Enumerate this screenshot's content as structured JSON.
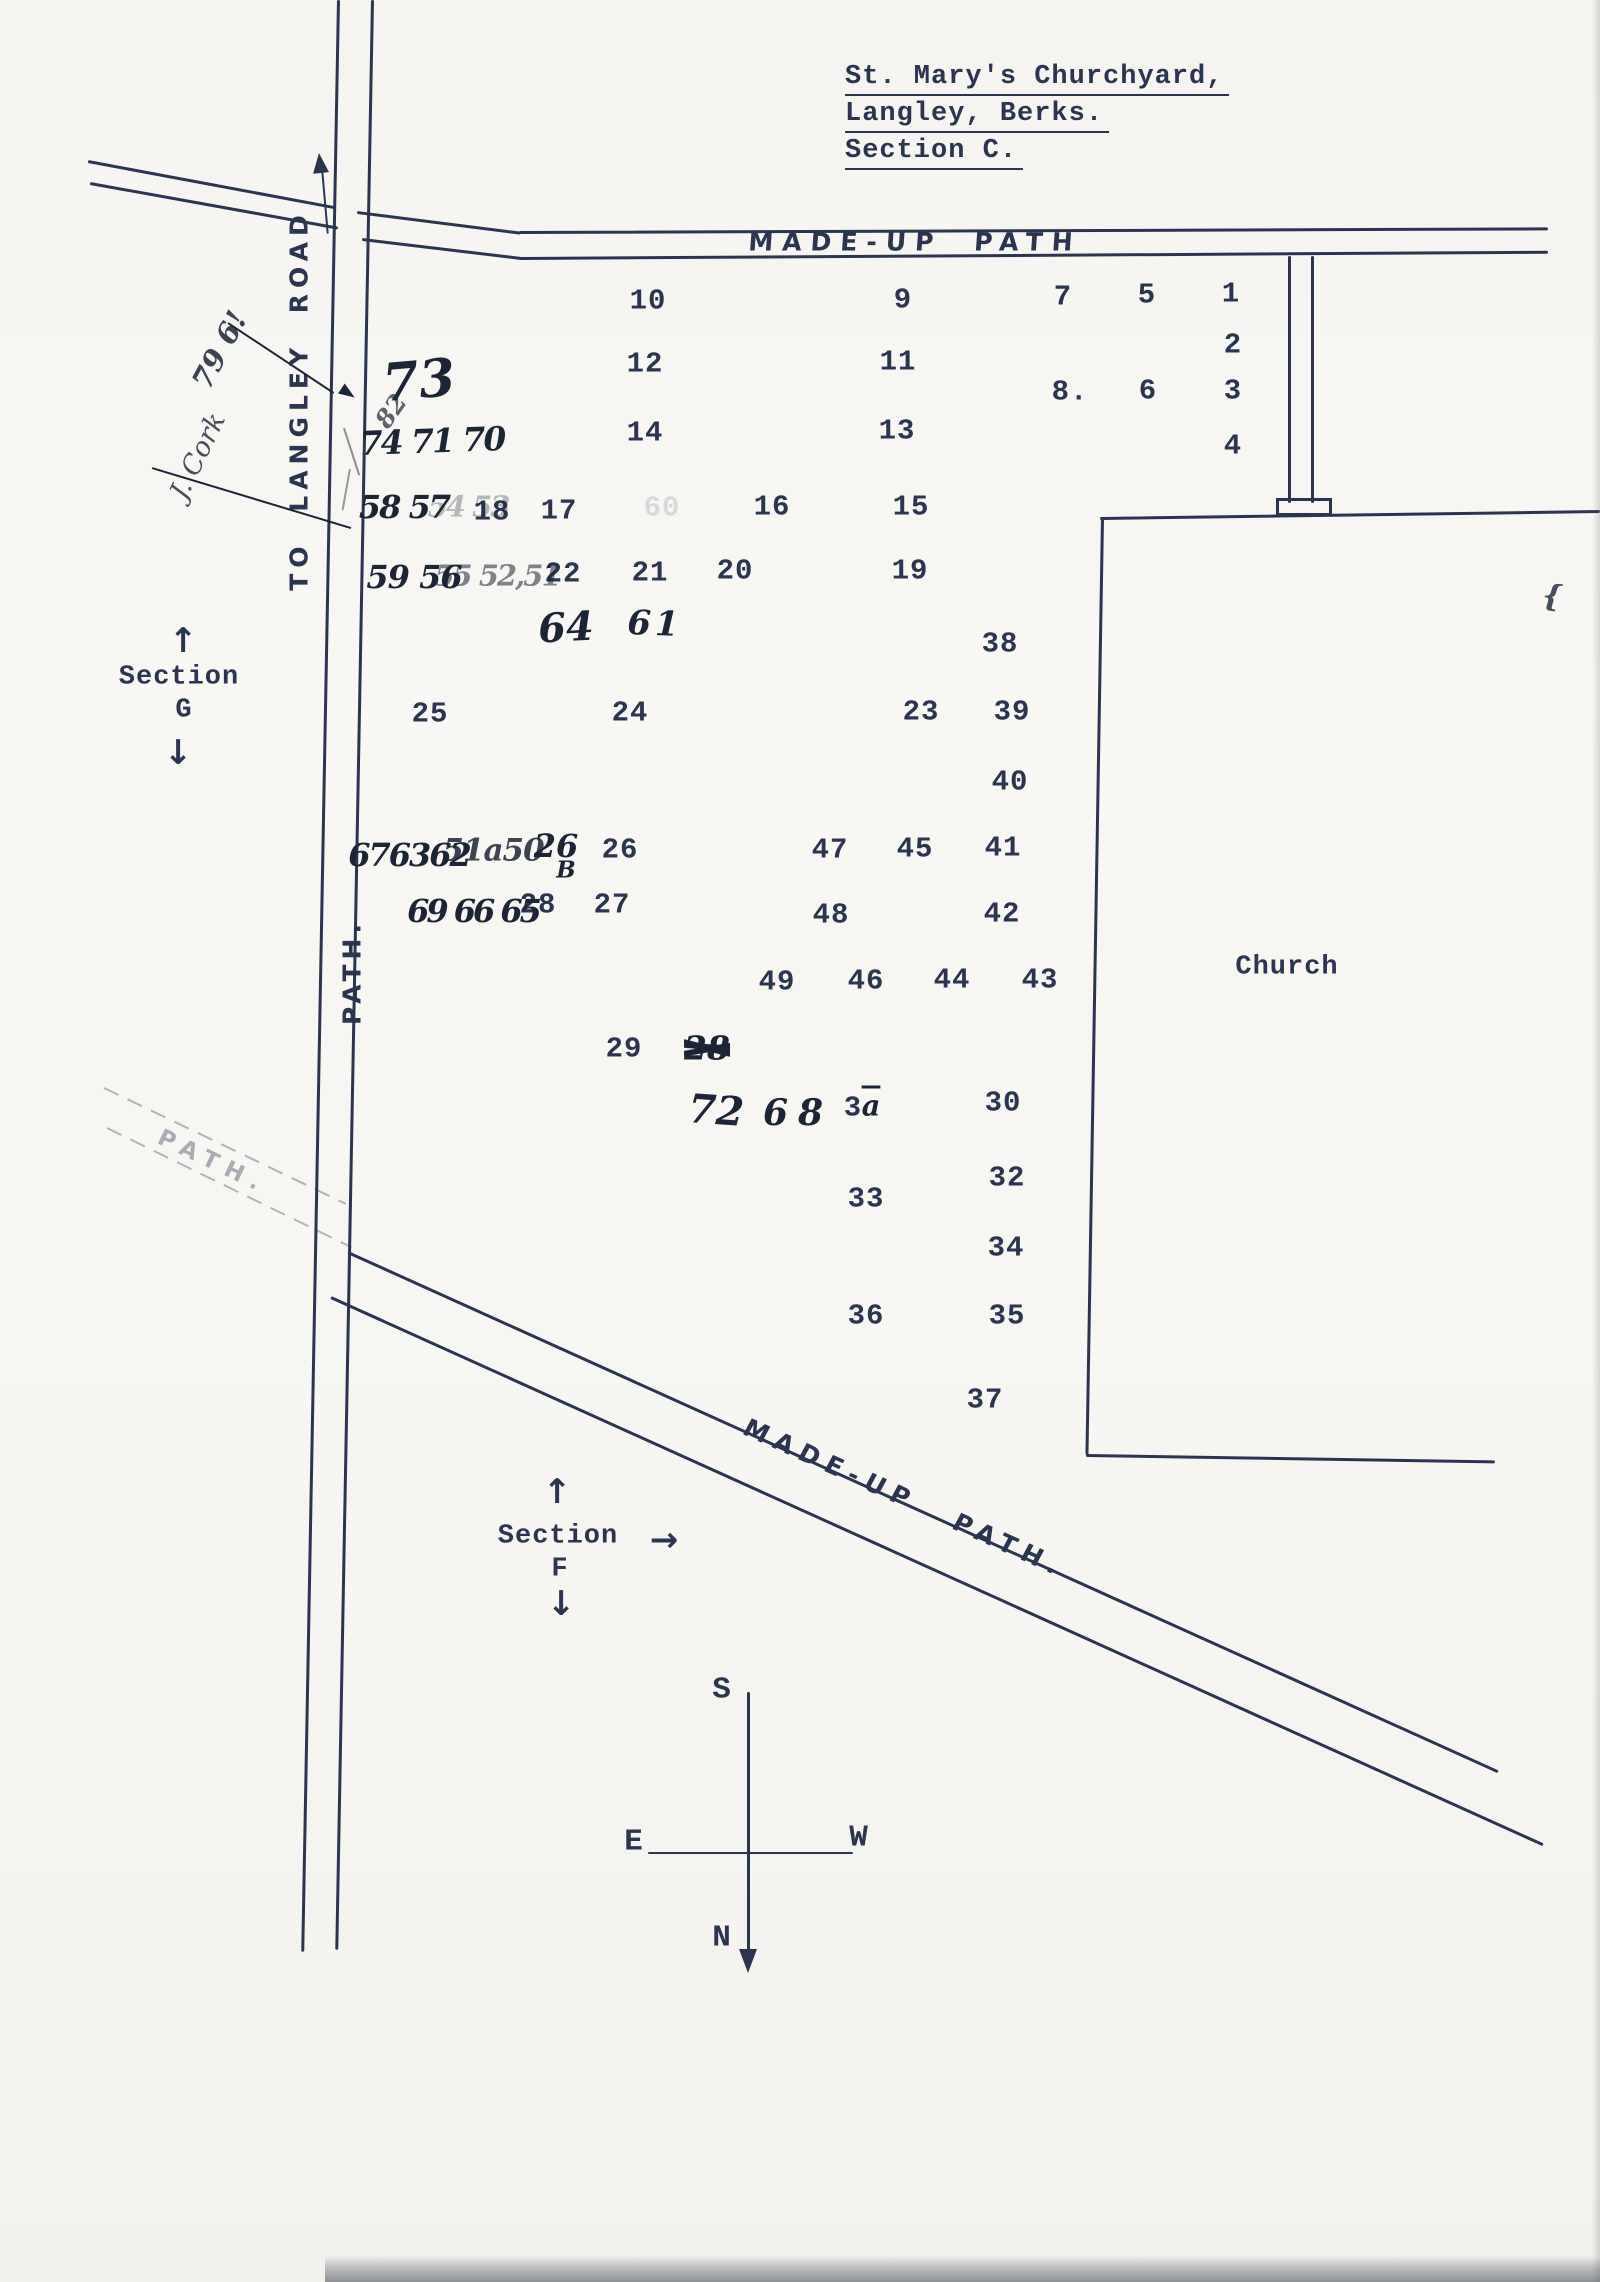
{
  "colors": {
    "ink": "#2b3550",
    "hand_ink": "#1c2536",
    "paper": "#f7f6f2",
    "scan_shadow": "#8e9196"
  },
  "title": {
    "line1": "St. Mary's Churchyard,",
    "line2": "Langley, Berks.",
    "line3": "Section C."
  },
  "path_labels": {
    "top": "MADE-UP PATH",
    "diagonal": "MADE-UP PATH.",
    "road_vertical": "TO LANGLEY ROAD",
    "path_vertical": "PATH.",
    "path_faint": "PATH."
  },
  "church_label": "Church",
  "sections": {
    "g": {
      "word": "Section",
      "letter": "G"
    },
    "f": {
      "word": "Section",
      "letter": "F"
    }
  },
  "compass": {
    "south": "S",
    "east": "E",
    "west": "W",
    "north": "N"
  },
  "arrows": {
    "up": "↑",
    "down": "↓",
    "right": "→"
  },
  "plots": [
    {
      "t": "10",
      "x": 648,
      "y": 301
    },
    {
      "t": "9",
      "x": 903,
      "y": 300
    },
    {
      "t": "7",
      "x": 1063,
      "y": 297
    },
    {
      "t": "5",
      "x": 1147,
      "y": 295
    },
    {
      "t": "1",
      "x": 1231,
      "y": 294
    },
    {
      "t": "2",
      "x": 1233,
      "y": 345
    },
    {
      "t": "12",
      "x": 645,
      "y": 364
    },
    {
      "t": "11",
      "x": 898,
      "y": 362
    },
    {
      "t": "8.",
      "x": 1070,
      "y": 392
    },
    {
      "t": "6",
      "x": 1148,
      "y": 391
    },
    {
      "t": "3",
      "x": 1233,
      "y": 391
    },
    {
      "t": "14",
      "x": 645,
      "y": 433
    },
    {
      "t": "13",
      "x": 897,
      "y": 431
    },
    {
      "t": "4",
      "x": 1233,
      "y": 446
    },
    {
      "t": "18",
      "x": 492,
      "y": 512
    },
    {
      "t": "17",
      "x": 559,
      "y": 511
    },
    {
      "t": "60",
      "x": 662,
      "y": 508,
      "o": 0.15
    },
    {
      "t": "16",
      "x": 772,
      "y": 507
    },
    {
      "t": "15",
      "x": 911,
      "y": 507
    },
    {
      "t": "22",
      "x": 563,
      "y": 574
    },
    {
      "t": "21",
      "x": 650,
      "y": 573
    },
    {
      "t": "20",
      "x": 735,
      "y": 571
    },
    {
      "t": "19",
      "x": 910,
      "y": 571
    },
    {
      "t": "38",
      "x": 1000,
      "y": 644
    },
    {
      "t": "25",
      "x": 430,
      "y": 714
    },
    {
      "t": "24",
      "x": 630,
      "y": 713
    },
    {
      "t": "23",
      "x": 921,
      "y": 712
    },
    {
      "t": "39",
      "x": 1012,
      "y": 712
    },
    {
      "t": "40",
      "x": 1010,
      "y": 782
    },
    {
      "t": "26",
      "x": 620,
      "y": 850
    },
    {
      "t": "28",
      "x": 538,
      "y": 905
    },
    {
      "t": "27",
      "x": 612,
      "y": 905
    },
    {
      "t": "47",
      "x": 830,
      "y": 850
    },
    {
      "t": "45",
      "x": 915,
      "y": 849
    },
    {
      "t": "41",
      "x": 1003,
      "y": 848
    },
    {
      "t": "48",
      "x": 831,
      "y": 915
    },
    {
      "t": "42",
      "x": 1002,
      "y": 914
    },
    {
      "t": "49",
      "x": 777,
      "y": 982
    },
    {
      "t": "46",
      "x": 866,
      "y": 981
    },
    {
      "t": "44",
      "x": 952,
      "y": 980
    },
    {
      "t": "43",
      "x": 1040,
      "y": 980
    },
    {
      "t": "29",
      "x": 624,
      "y": 1049
    },
    {
      "t": "3",
      "x": 853,
      "y": 1108
    },
    {
      "t": "30",
      "x": 1003,
      "y": 1103
    },
    {
      "t": "33",
      "x": 866,
      "y": 1199
    },
    {
      "t": "32",
      "x": 1007,
      "y": 1178
    },
    {
      "t": "34",
      "x": 1006,
      "y": 1248
    },
    {
      "t": "36",
      "x": 866,
      "y": 1316
    },
    {
      "t": "35",
      "x": 1007,
      "y": 1316
    },
    {
      "t": "37",
      "x": 985,
      "y": 1400
    }
  ],
  "handwritten": [
    {
      "t": "73",
      "x": 419,
      "y": 381,
      "s": 52,
      "r": -5
    },
    {
      "t": "74 71 70",
      "x": 432,
      "y": 441,
      "s": 33,
      "r": -2,
      "ls": -2
    },
    {
      "t": "82",
      "x": 391,
      "y": 411,
      "s": 25,
      "r": -55,
      "o": 0.7
    },
    {
      "t": "79 6!",
      "x": 220,
      "y": 350,
      "s": 29,
      "r": -62,
      "o": 0.85
    },
    {
      "t": "J. Cork",
      "x": 198,
      "y": 456,
      "s": 27,
      "r": -64,
      "o": 0.8,
      "cursive": true
    },
    {
      "t": "58 57",
      "x": 404,
      "y": 507,
      "s": 32,
      "ls": -2
    },
    {
      "t": "54 53",
      "x": 468,
      "y": 507,
      "s": 29,
      "o": 0.3,
      "ls": -2
    },
    {
      "t": "59 56",
      "x": 414,
      "y": 577,
      "s": 32,
      "ls": -1
    },
    {
      "t": "55 52,51",
      "x": 497,
      "y": 576,
      "s": 29,
      "o": 0.55,
      "ls": -2
    },
    {
      "t": "64",
      "x": 566,
      "y": 628,
      "s": 40,
      "r": -3
    },
    {
      "t": "61",
      "x": 655,
      "y": 624,
      "s": 34,
      "r": 2,
      "ls": 4
    },
    {
      "t": "676362",
      "x": 409,
      "y": 855,
      "s": 32,
      "ls": -2
    },
    {
      "t": "51a50",
      "x": 493,
      "y": 851,
      "s": 31,
      "ls": -1,
      "o": 0.85
    },
    {
      "t": "26",
      "x": 556,
      "y": 846,
      "s": 32
    },
    {
      "t": "B",
      "x": 566,
      "y": 870,
      "s": 23
    },
    {
      "t": "69 66 65",
      "x": 473,
      "y": 911,
      "s": 32,
      "ls": -3
    },
    {
      "t": "28",
      "x": 707,
      "y": 1048,
      "s": 33,
      "scr": true
    },
    {
      "t": "72",
      "x": 716,
      "y": 1111,
      "s": 40,
      "r": 4
    },
    {
      "t": "68",
      "x": 798,
      "y": 1113,
      "s": 36,
      "ls": 10
    },
    {
      "t": "a",
      "x": 871,
      "y": 1106,
      "s": 29,
      "ov": true
    },
    {
      "t": "{",
      "x": 1552,
      "y": 597,
      "s": 30,
      "r": 6,
      "o": 0.8
    }
  ]
}
